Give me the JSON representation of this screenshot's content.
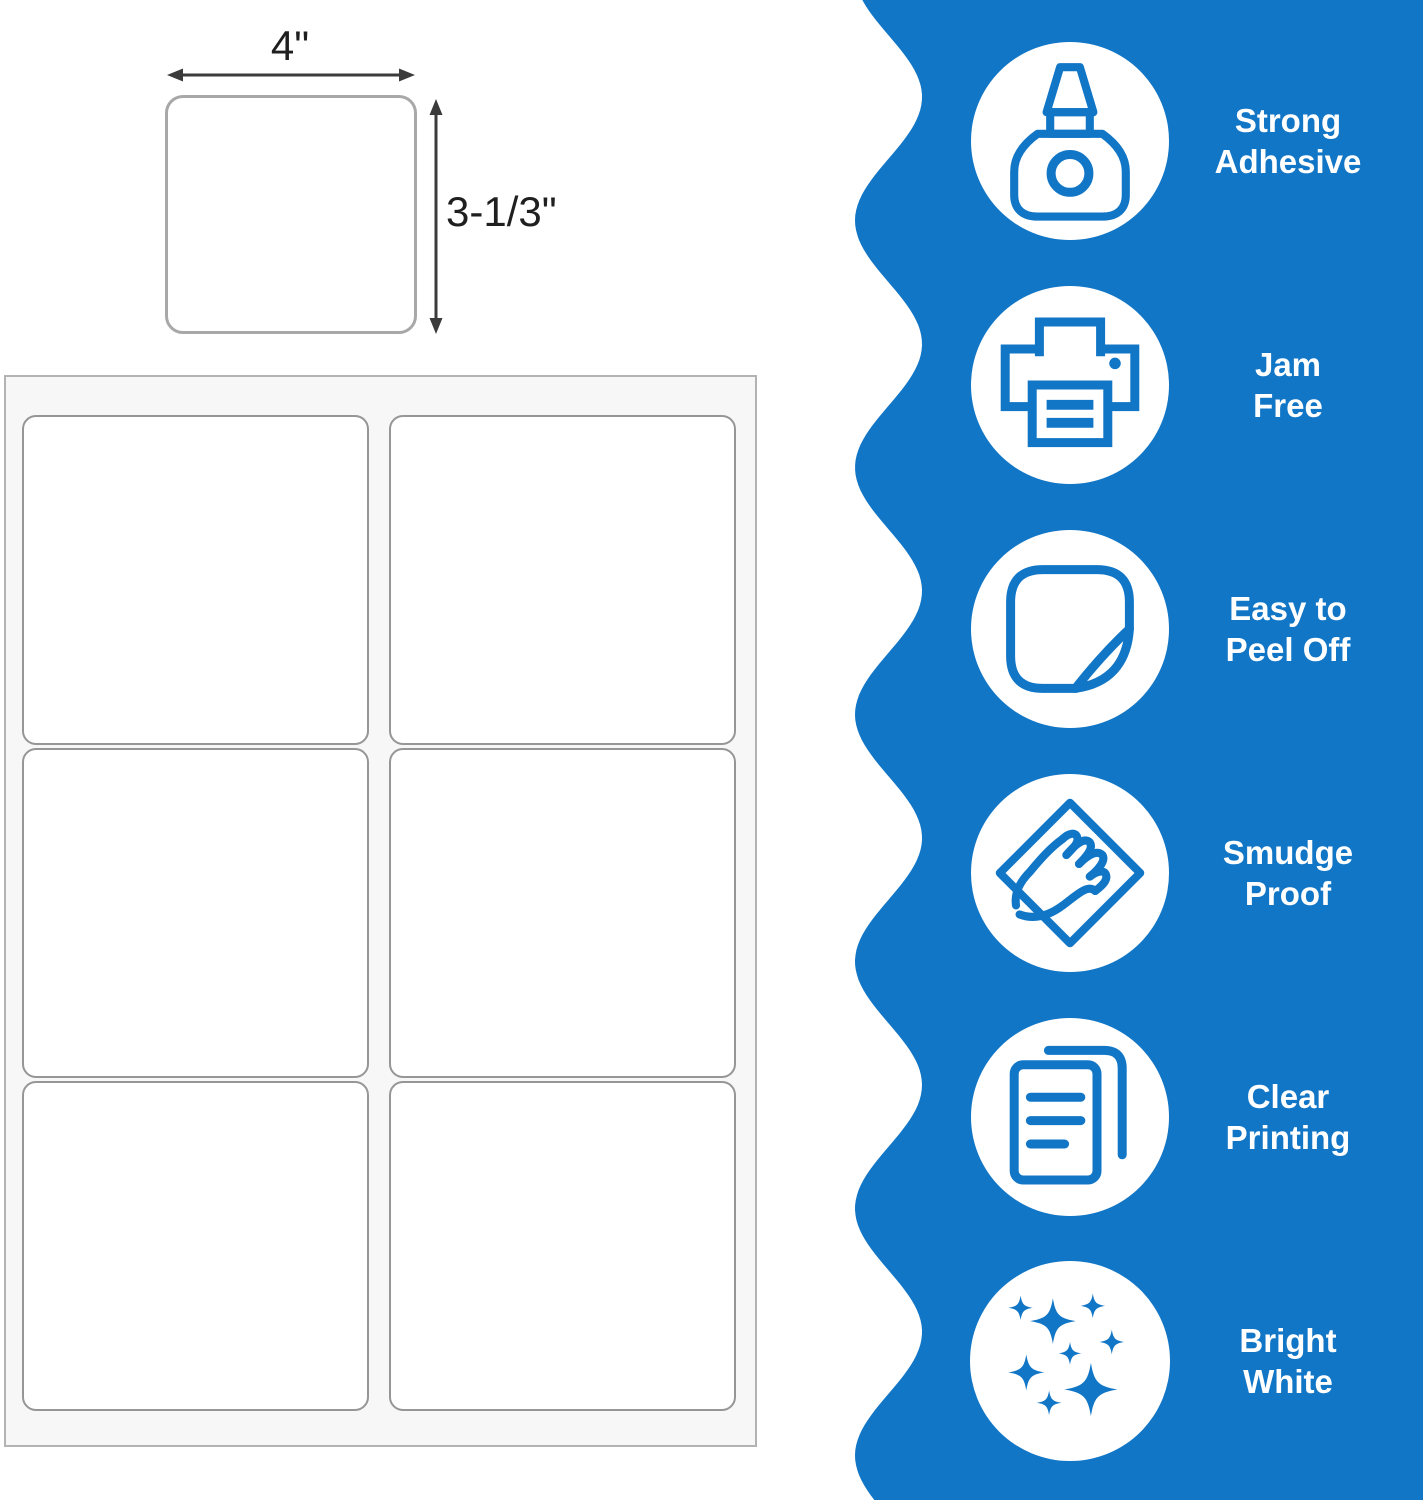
{
  "diagram": {
    "width_label": "4\"",
    "height_label": "3-1/3\""
  },
  "sheet": {
    "columns": 2,
    "rows": 3,
    "labels_per_sheet": 6
  },
  "features": {
    "items": [
      {
        "icon": "glue-bottle-icon",
        "line1": "Strong",
        "line2": "Adhesive"
      },
      {
        "icon": "printer-icon",
        "line1": "Jam",
        "line2": "Free"
      },
      {
        "icon": "peel-sticker-icon",
        "line1": "Easy to",
        "line2": "Peel Off"
      },
      {
        "icon": "smudge-hand-icon",
        "line1": "Smudge",
        "line2": "Proof"
      },
      {
        "icon": "documents-icon",
        "line1": "Clear",
        "line2": "Printing"
      },
      {
        "icon": "sparkles-icon",
        "line1": "Bright",
        "line2": "White"
      }
    ]
  },
  "colors": {
    "brand_blue": "#1276c7",
    "icon_blue": "#1276c7",
    "circle_fill": "#ffffff",
    "sheet_fill": "#f7f7f7",
    "sheet_border": "#b3b3b3",
    "label_border": "#969696",
    "single_label_border": "#a8a8a8",
    "dimension_ink": "#3b3b3b",
    "feature_text": "#ffffff"
  }
}
